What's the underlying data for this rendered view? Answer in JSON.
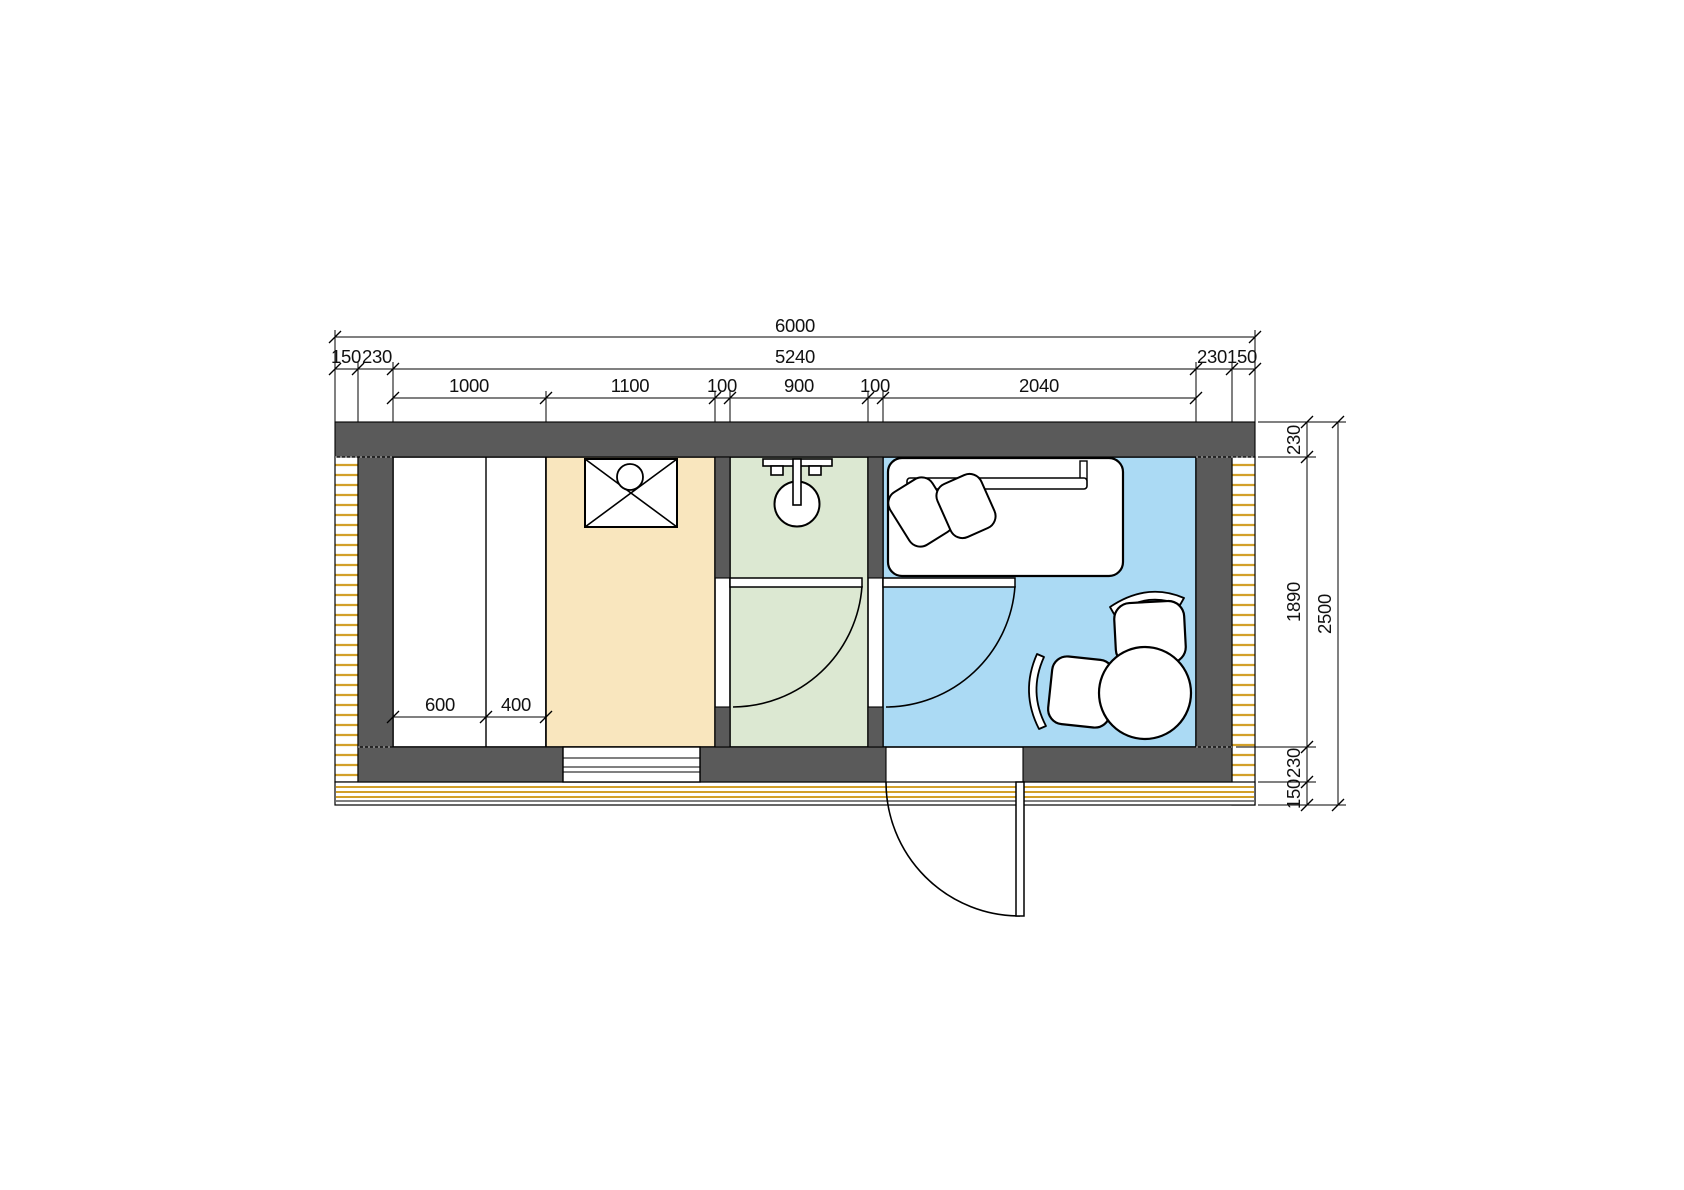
{
  "drawing": {
    "type": "architectural-floor-plan",
    "units": "mm"
  },
  "colors": {
    "paper": "#ffffff",
    "wall": "#5a5a5a",
    "shower_room": "#f9e6be",
    "wash_room": "#dce8d2",
    "rest_room": "#abdaf4",
    "deck": "#d2a02a",
    "joint_dotted": "#9a9a9a"
  },
  "dimensions": {
    "top": {
      "overall": "6000",
      "inner": "5240",
      "left": [
        "150",
        "230"
      ],
      "right": [
        "230",
        "150"
      ],
      "segments": [
        "1000",
        "1100",
        "100",
        "900",
        "100",
        "2040"
      ]
    },
    "side": {
      "top_wall": "230",
      "interior": "1890",
      "bottom_wall": "230",
      "deck": "150",
      "overall": "2500"
    },
    "closet": [
      "600",
      "400"
    ]
  }
}
